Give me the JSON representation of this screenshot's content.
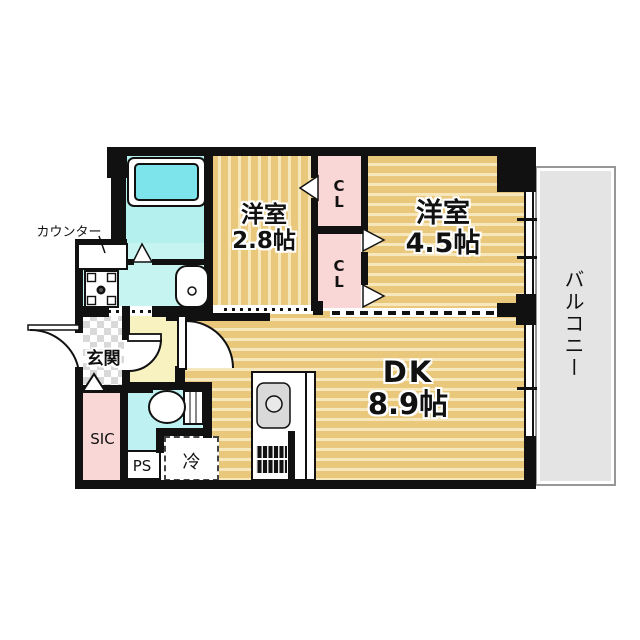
{
  "plan": {
    "rooms": {
      "bedroom1": {
        "name": "洋室",
        "size": "2.8帖"
      },
      "bedroom2": {
        "name": "洋室",
        "size": "4.5帖"
      },
      "dining_kitchen": {
        "name": "DK",
        "size": "8.9帖"
      },
      "balcony": {
        "label": "バルコニー"
      },
      "entrance": {
        "label": "玄関"
      },
      "shoe_closet": {
        "label": "SIC"
      },
      "pipe_space": {
        "label": "PS"
      },
      "refrigerator": {
        "label": "冷"
      },
      "closet_upper": {
        "label": "CL"
      },
      "closet_lower": {
        "label": "CL"
      },
      "counter": {
        "label": "カウンター"
      }
    },
    "colors": {
      "wall": "#111111",
      "floor_tan": "#e9c87c",
      "floor_stripe": "#f6e8bc",
      "closet_pink": "#f9d7d7",
      "bath_cyan": "#b4f0ee",
      "sanitary_cyan": "#c6f4f0",
      "tub_cyan": "#7ce4ea",
      "hall_cream": "#f8f2c0",
      "balcony_gray": "#e4e4e4",
      "entrance_tile": "#d9d9d9"
    }
  }
}
